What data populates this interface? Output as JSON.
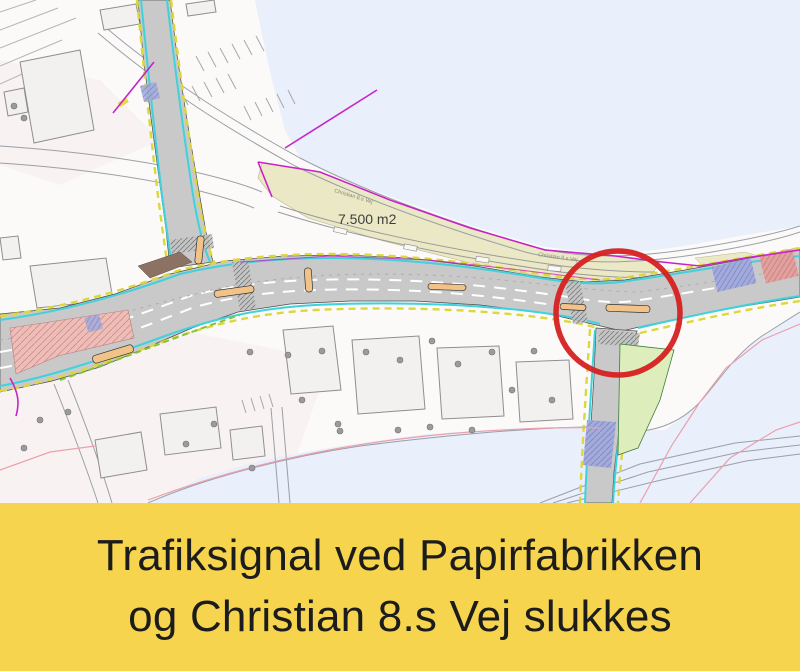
{
  "banner": {
    "line1": "Trafiksignal ved Papirfabrikken",
    "line2": "og Christian 8.s Vej slukkes",
    "background_color": "#f6d44d",
    "text_color": "#1c1c1c"
  },
  "map": {
    "labels": {
      "area": "7.500 m2",
      "road_name": "Christian 8.s Vej",
      "road_name_2": "Christian 8.s Vej"
    },
    "colors": {
      "water": "#e9effb",
      "land": "#fbfaf9",
      "parcel": "#ebe8c6",
      "road": "#c9c9c9",
      "bike_lane": "#3fd2dc",
      "edge_marking": "#ddd83a",
      "cadastral": "#c724c7",
      "highlight": "#d62121",
      "construction_area": "#eebdb8",
      "crosswalk_area": "#a3abdc",
      "green_verge": "#ddedbb"
    },
    "highlight_circle": {
      "cx": 618,
      "cy": 313,
      "r": 62
    }
  }
}
